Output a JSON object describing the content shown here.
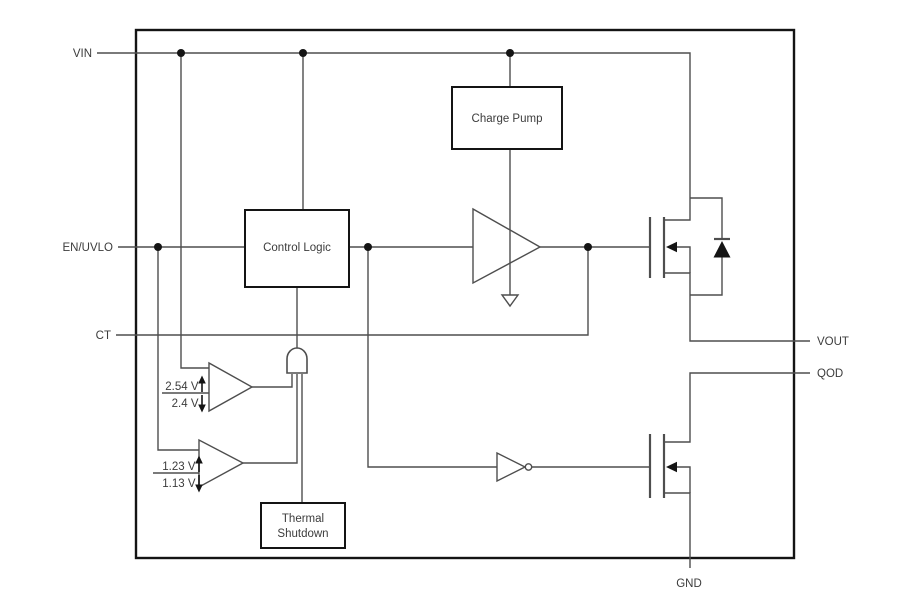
{
  "diagram": {
    "pins": {
      "vin": "VIN",
      "en_uvlo": "EN/UVLO",
      "ct": "CT",
      "vout": "VOUT",
      "qod": "QOD",
      "gnd": "GND"
    },
    "blocks": {
      "charge_pump": "Charge Pump",
      "control_logic": "Control Logic",
      "thermal_shutdown_line1": "Thermal",
      "thermal_shutdown_line2": "Shutdown"
    },
    "comparators": {
      "vin_uvlo": {
        "rising_threshold": "2.54 V",
        "falling_threshold": "2.4 V"
      },
      "en_uvlo": {
        "rising_threshold": "1.23 V",
        "falling_threshold": "1.13 V"
      }
    },
    "colors": {
      "background": "#ffffff",
      "wire": "#4e4e4e",
      "block_border": "#141414",
      "text": "#3c3c3c"
    }
  }
}
